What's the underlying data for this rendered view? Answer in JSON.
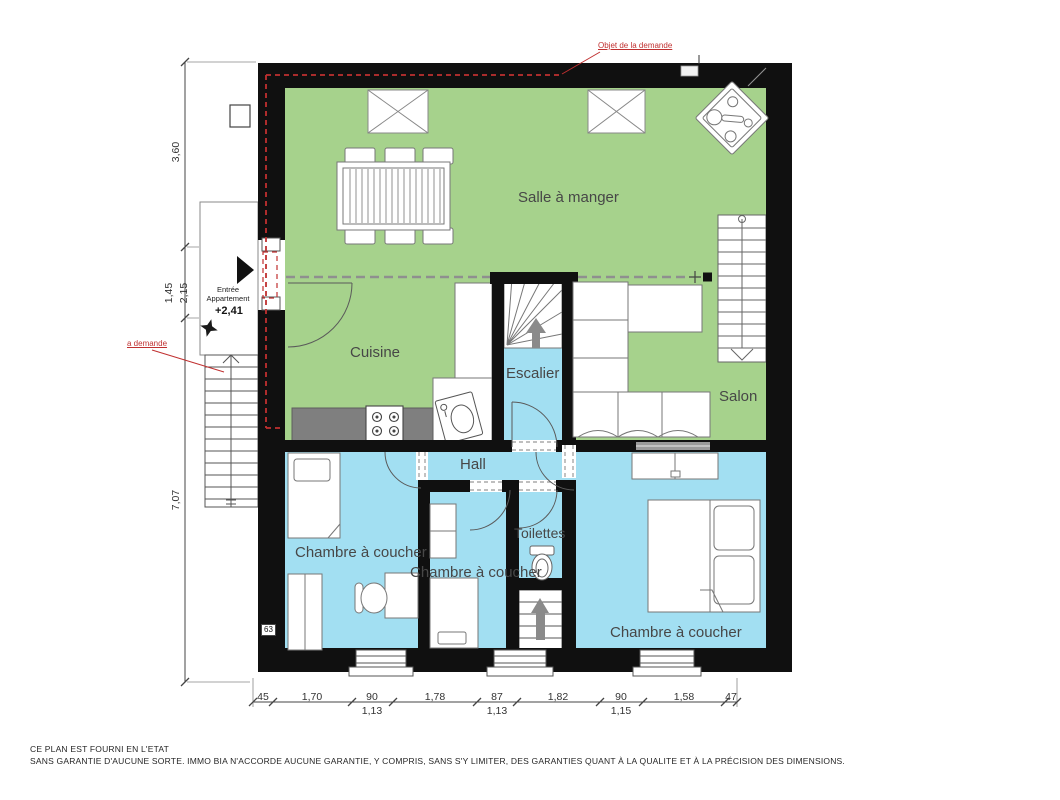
{
  "title": "Plan d'appartement",
  "rooms": {
    "salle_a_manger": "Salle à manger",
    "cuisine": "Cuisine",
    "escalier": "Escalier",
    "salon": "Salon",
    "hall": "Hall",
    "toilettes": "Toilettes",
    "chambre_gauche": "Chambre à coucher",
    "chambre_milieu": "Chambre à coucher",
    "chambre_droite": "Chambre à coucher"
  },
  "annotations": {
    "top_note": "Objet de la demande",
    "left_note": "a demande",
    "entrance_line1": "Entrée",
    "entrance_line2": "Appartement",
    "level_mark": "+2,41",
    "wall_tag": "63"
  },
  "dimensions": {
    "left": [
      {
        "label": "3,60"
      },
      {
        "label": "1,45"
      },
      {
        "label": "2,15"
      },
      {
        "label": "7,07"
      }
    ],
    "bottom": [
      {
        "main": "45"
      },
      {
        "main": "1,70"
      },
      {
        "main": "90",
        "sub": "1,13"
      },
      {
        "main": "1,78"
      },
      {
        "main": "87",
        "sub": "1,13"
      },
      {
        "main": "1,82"
      },
      {
        "main": "90",
        "sub": "1,15"
      },
      {
        "main": "1,58"
      },
      {
        "main": "47"
      }
    ]
  },
  "footer": {
    "line1": "CE PLAN EST FOURNI EN L'ETAT",
    "line2": "SANS GARANTIE D'AUCUNE SORTE. IMMO BIA N'ACCORDE AUCUNE GARANTIE, Y COMPRIS, SANS S'Y LIMITER, DES GARANTIES QUANT À LA QUALITE ET À LA PRÉCISION DES DIMENSIONS."
  },
  "colors": {
    "room_green": "#a6d28c",
    "room_blue": "#a2dff2",
    "wall_black": "#101010",
    "annotation_red": "#c03030",
    "counter_gray": "#7f7f7f",
    "furniture_stroke": "#6b6b6b"
  }
}
